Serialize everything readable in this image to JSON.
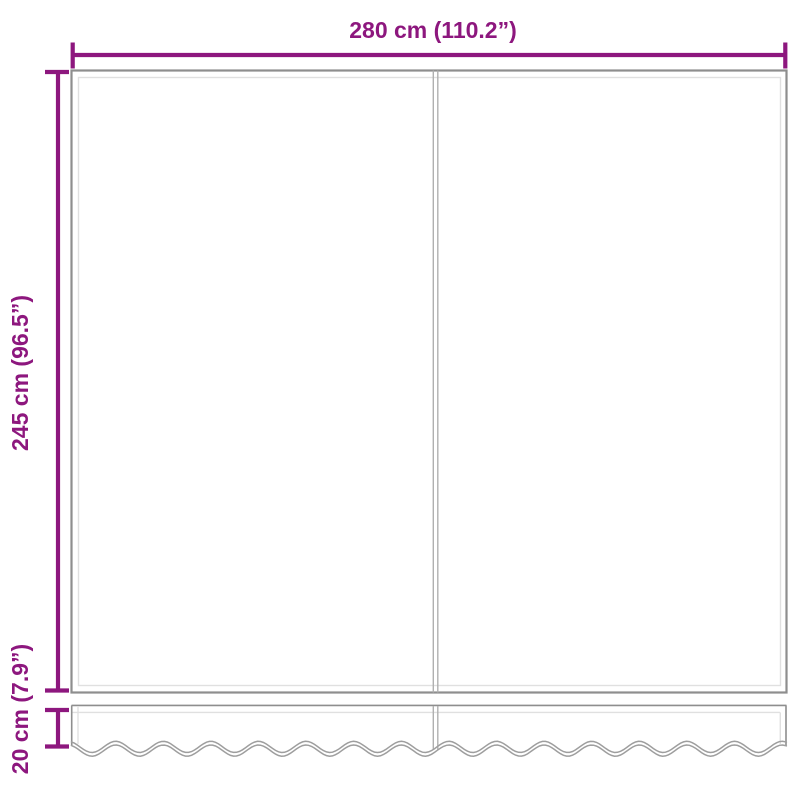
{
  "labels": {
    "width": "280 cm (110.2”)",
    "height": "245 cm (96.5”)",
    "valance_height": "20 cm (7.9”)"
  },
  "colors": {
    "dimension_accent": "#8d177e",
    "outline_gray": "#8e8e8e",
    "divider_gray": "#b0b0b0",
    "seam_light_gray": "#e0e0e0",
    "wave_gray": "#9e9e9e"
  }
}
